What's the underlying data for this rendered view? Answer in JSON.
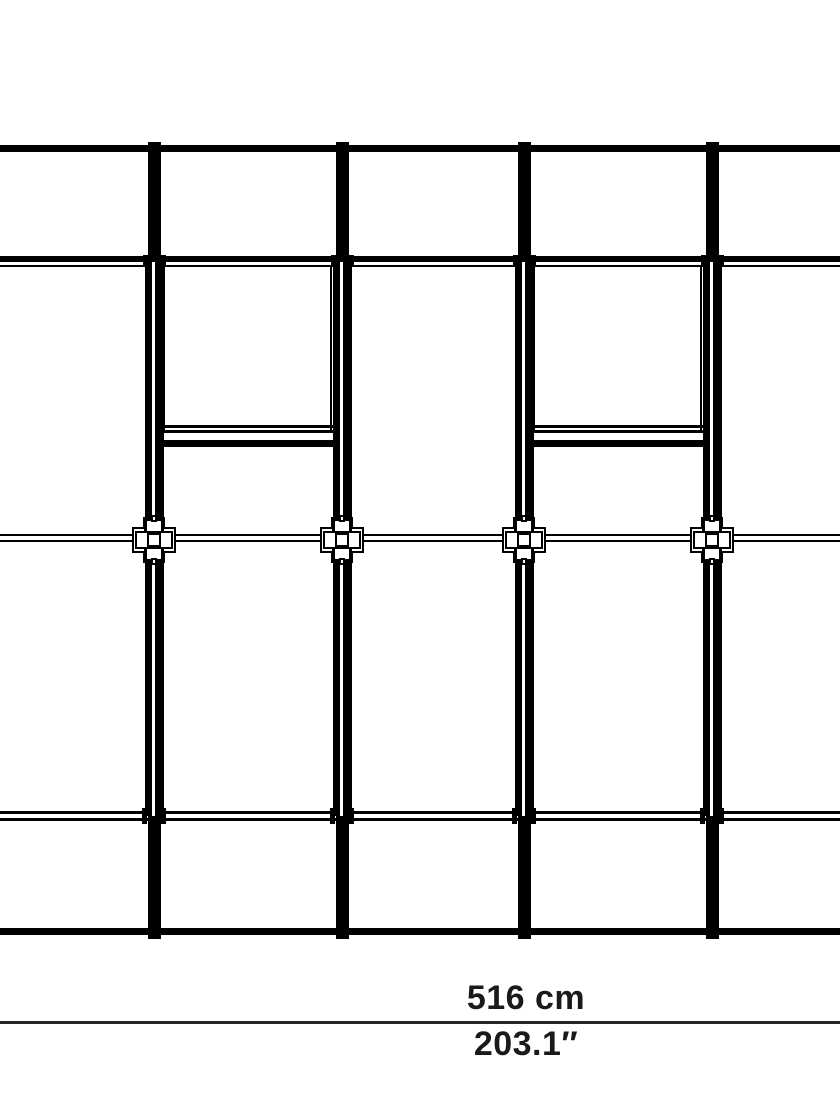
{
  "diagram": {
    "description": "frame-elevation-line-drawing",
    "dimension": {
      "metric": "516 cm",
      "imperial": "203.1″"
    }
  },
  "colors": {
    "line": "#000000",
    "dimension_line": "#262626",
    "text": "#1a1a1a",
    "background": "#ffffff"
  }
}
